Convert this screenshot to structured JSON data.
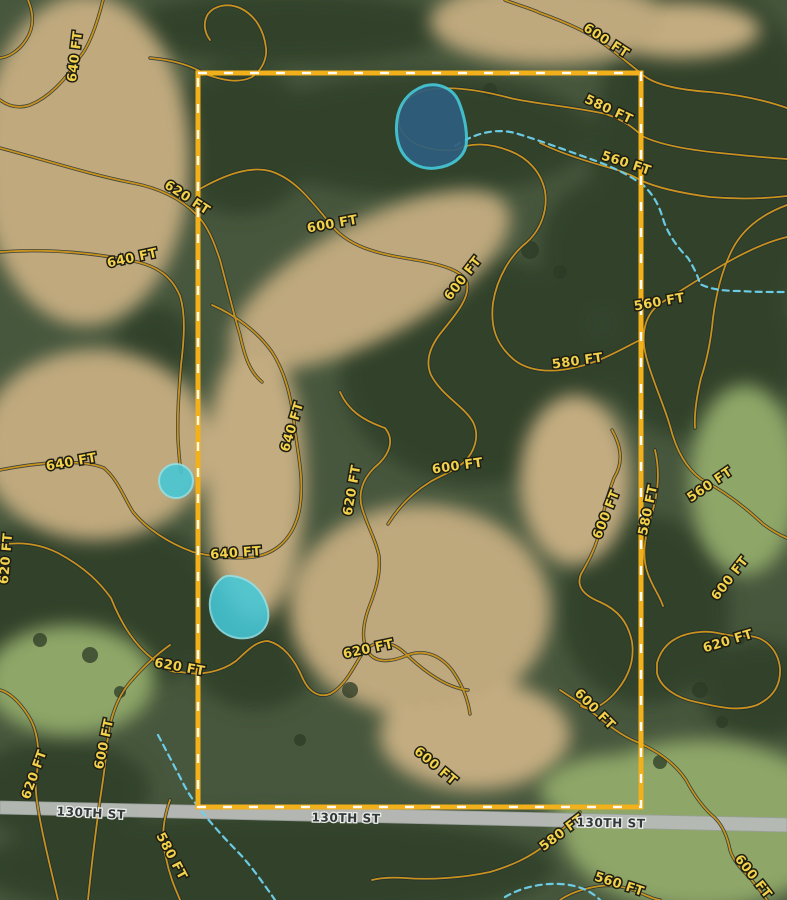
{
  "map": {
    "elevation_unit": "FT",
    "elevations_shown": [
      560,
      580,
      600,
      620,
      640
    ],
    "contour_labels": [
      {
        "text": "640 FT",
        "x": 79,
        "y": 57,
        "rot": -83
      },
      {
        "text": "600 FT",
        "x": 604,
        "y": 44,
        "rot": 33
      },
      {
        "text": "580 FT",
        "x": 607,
        "y": 113,
        "rot": 25
      },
      {
        "text": "560 FT",
        "x": 625,
        "y": 167,
        "rot": 18
      },
      {
        "text": "620 FT",
        "x": 185,
        "y": 201,
        "rot": 33
      },
      {
        "text": "600 FT",
        "x": 333,
        "y": 228,
        "rot": -10
      },
      {
        "text": "640 FT",
        "x": 133,
        "y": 262,
        "rot": -12
      },
      {
        "text": "600 FT",
        "x": 466,
        "y": 281,
        "rot": -52
      },
      {
        "text": "560 FT",
        "x": 660,
        "y": 306,
        "rot": -10
      },
      {
        "text": "580 FT",
        "x": 578,
        "y": 365,
        "rot": -8
      },
      {
        "text": "640 FT",
        "x": 296,
        "y": 428,
        "rot": -73
      },
      {
        "text": "640 FT",
        "x": 72,
        "y": 466,
        "rot": -10
      },
      {
        "text": "600 FT",
        "x": 458,
        "y": 470,
        "rot": -8
      },
      {
        "text": "620 FT",
        "x": 356,
        "y": 491,
        "rot": -80
      },
      {
        "text": "560 FT",
        "x": 712,
        "y": 488,
        "rot": -34
      },
      {
        "text": "580 FT",
        "x": 652,
        "y": 511,
        "rot": -78
      },
      {
        "text": "600 FT",
        "x": 610,
        "y": 516,
        "rot": -68
      },
      {
        "text": "640 FT",
        "x": 236,
        "y": 557,
        "rot": -4
      },
      {
        "text": "620 FT",
        "x": 10,
        "y": 559,
        "rot": -85
      },
      {
        "text": "600 FT",
        "x": 733,
        "y": 581,
        "rot": -52
      },
      {
        "text": "620 FT",
        "x": 729,
        "y": 645,
        "rot": -17
      },
      {
        "text": "620 FT",
        "x": 369,
        "y": 653,
        "rot": -12
      },
      {
        "text": "620 FT",
        "x": 179,
        "y": 671,
        "rot": 10
      },
      {
        "text": "600 FT",
        "x": 592,
        "y": 712,
        "rot": 45
      },
      {
        "text": "600 FT",
        "x": 108,
        "y": 745,
        "rot": -78
      },
      {
        "text": "620 FT",
        "x": 38,
        "y": 776,
        "rot": -70
      },
      {
        "text": "600 FT",
        "x": 433,
        "y": 769,
        "rot": 40
      },
      {
        "text": "580 FT",
        "x": 168,
        "y": 858,
        "rot": 62
      },
      {
        "text": "580 FT",
        "x": 564,
        "y": 836,
        "rot": -37
      },
      {
        "text": "560 FT",
        "x": 618,
        "y": 888,
        "rot": 18
      },
      {
        "text": "600 FT",
        "x": 750,
        "y": 879,
        "rot": 52
      }
    ],
    "road_labels": [
      {
        "text": "130TH ST",
        "x": 91,
        "y": 817,
        "rot": 3
      },
      {
        "text": "130TH ST",
        "x": 346,
        "y": 822,
        "rot": 1
      },
      {
        "text": "130TH ST",
        "x": 611,
        "y": 827,
        "rot": 1
      }
    ],
    "water_features": {
      "pond_count": 3,
      "stream_style": "dashed-intermittent"
    },
    "colors": {
      "contour": "#c8921c",
      "contour_casing": "#1d2b33",
      "boundary": "#f2b01a",
      "boundary_dash": "#ffffff",
      "pond_fill": "#45c8d8",
      "pond_deep": "#2e5e7e",
      "stream": "#6fd2ee",
      "road_fill": "#b7bab6",
      "contour_label_fill": "#f2d24b",
      "contour_label_halo": "#1f1e14",
      "road_label_fill": "#33383b",
      "road_label_halo": "#e9ebe7"
    }
  }
}
